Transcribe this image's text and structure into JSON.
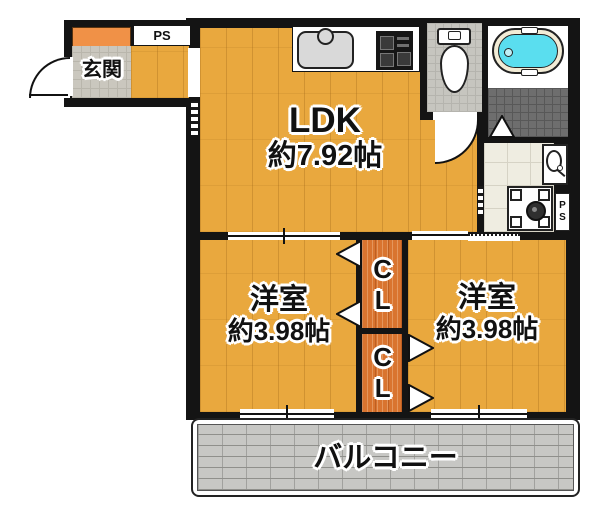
{
  "floorplan": {
    "entrance": {
      "label": "玄関"
    },
    "pipe_space_top": {
      "label": "PS"
    },
    "ldk": {
      "label": "LDK",
      "area": "約7.92帖"
    },
    "bedroom_left": {
      "label": "洋室",
      "area": "約3.98帖"
    },
    "bedroom_right": {
      "label": "洋室",
      "area": "約3.98帖"
    },
    "closet_upper": {
      "label": "CL"
    },
    "closet_lower": {
      "label": "CL"
    },
    "pipe_space_right": {
      "label": "PS"
    },
    "balcony": {
      "label": "バルコニー"
    },
    "colors": {
      "wall": "#141414",
      "wood_floor": "#E9A83E",
      "closet_wood": "#D9742F",
      "shoe_cabinet": "#F09147",
      "genkan_tile": "#CAC7BE",
      "bath_floor": "#6E6E6E",
      "washroom_floor": "#EFEDE1",
      "bathtub_water": "#5ADEEF",
      "bathtub_rim": "#F2ECD6",
      "balcony_tile": "#C7C7C4",
      "text": "#111111"
    }
  }
}
